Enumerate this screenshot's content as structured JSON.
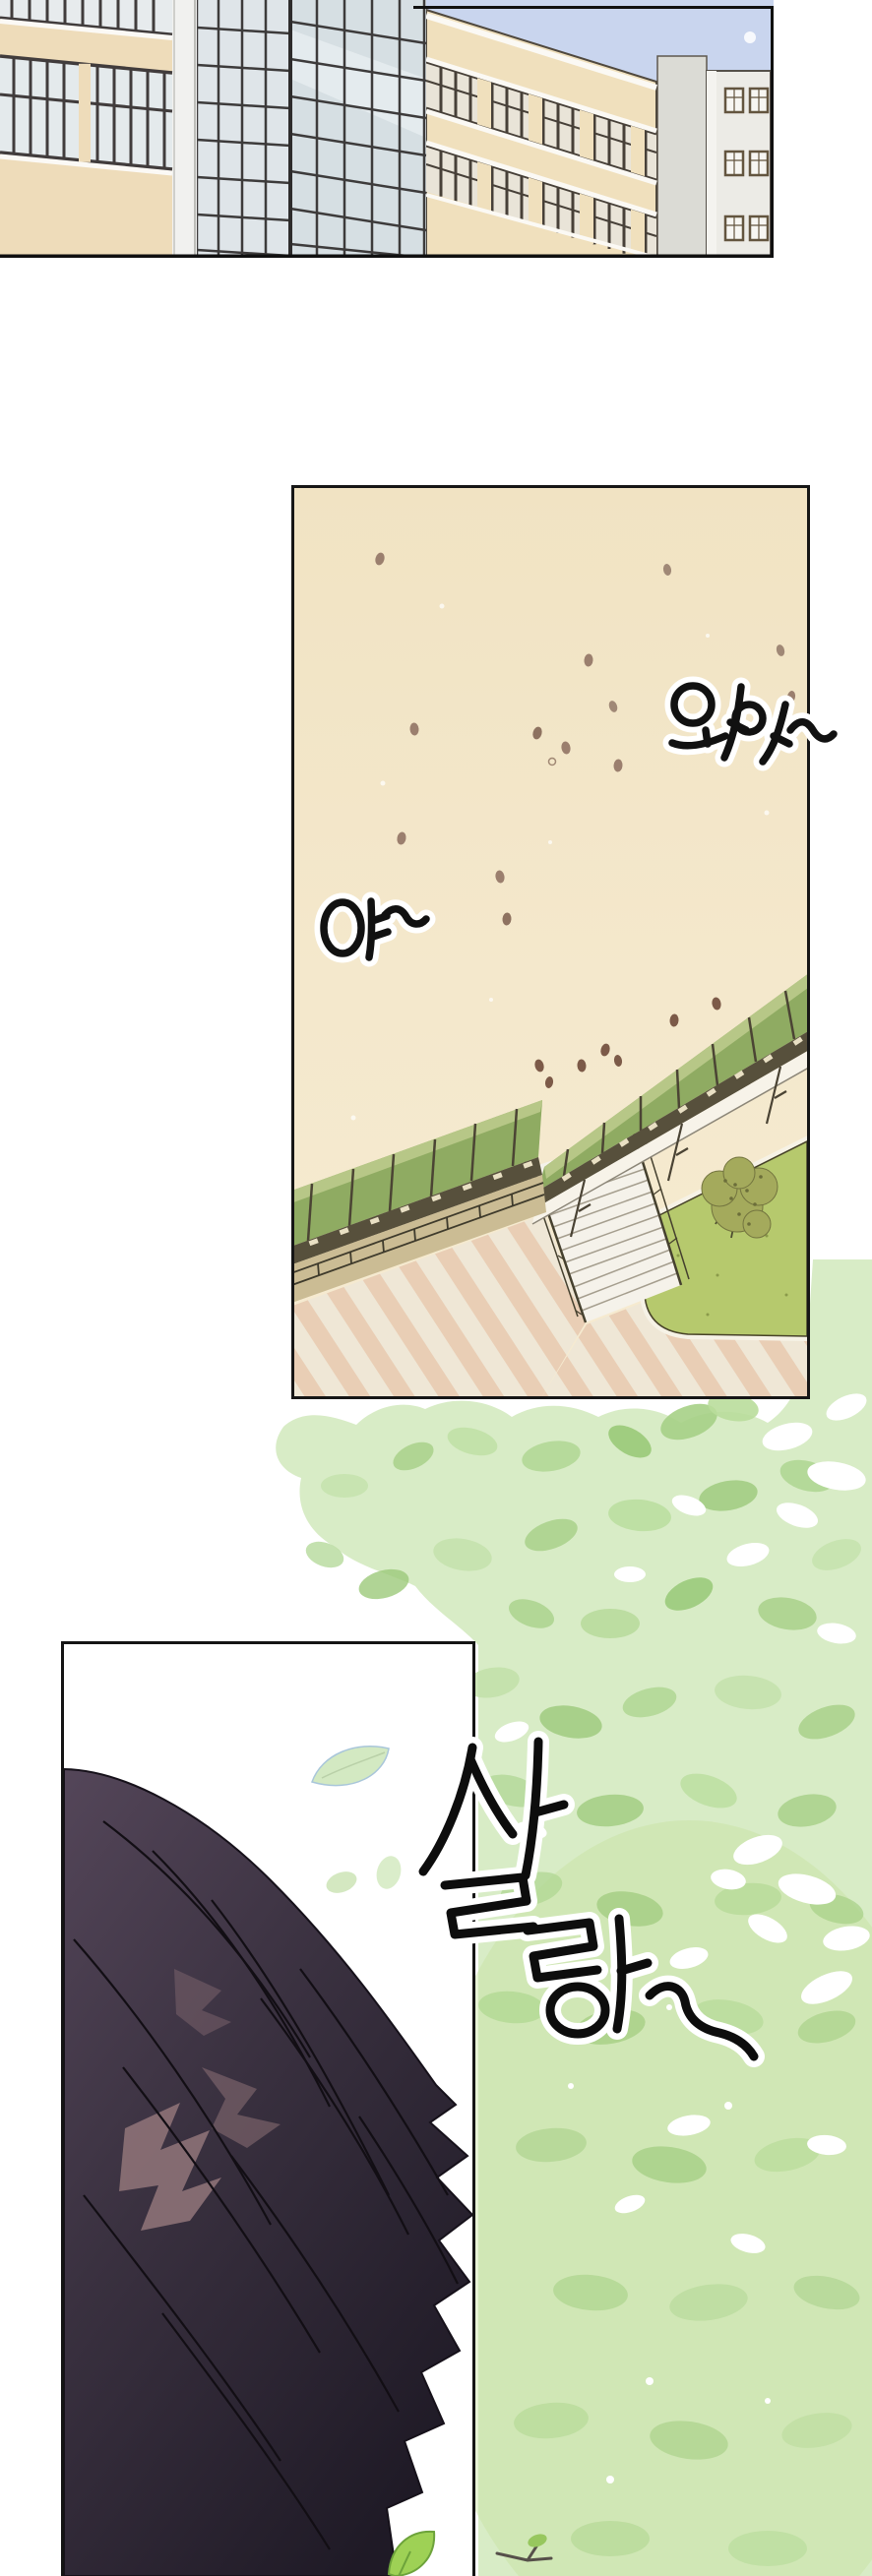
{
  "page": {
    "label": "webtoon comic page",
    "background": "#ffffff"
  },
  "panel1": {
    "name": "city buildings establishing shot",
    "sky_color": "#c9d5ee",
    "cream_building_color": "#efdfbd",
    "glass_building_color": "#d7dfe4",
    "white_building_color": "#ecebe6"
  },
  "panel2": {
    "name": "aerial schoolyard with green canopy walkways",
    "bg_color": "#f3e7ca",
    "canopy_color": "#8fab62",
    "lawn_color": "#b6c96d",
    "stripe_colors": [
      "#efe7d6",
      "#e9ceb5"
    ],
    "falling_leaf_color": "#9b7f6e",
    "sfx": [
      {
        "id": "waa",
        "text": "와아~"
      },
      {
        "id": "ya",
        "text": "야~"
      }
    ]
  },
  "panel3": {
    "name": "close-up of dark hair in the breeze",
    "bg_color": "#ffffff",
    "hair_color": "#3b323f",
    "hair_highlight_color": "#8d7277",
    "leaf_color": "#9ed155",
    "sfx": [
      {
        "id": "sallang",
        "text": "살랑~"
      }
    ]
  },
  "foliage": {
    "name": "tree canopy watercolor background",
    "base_color": "#d8ecc6",
    "accent_colors": [
      "#a6d086",
      "#9cc97a",
      "#c4e2ab",
      "#ffffff"
    ]
  }
}
